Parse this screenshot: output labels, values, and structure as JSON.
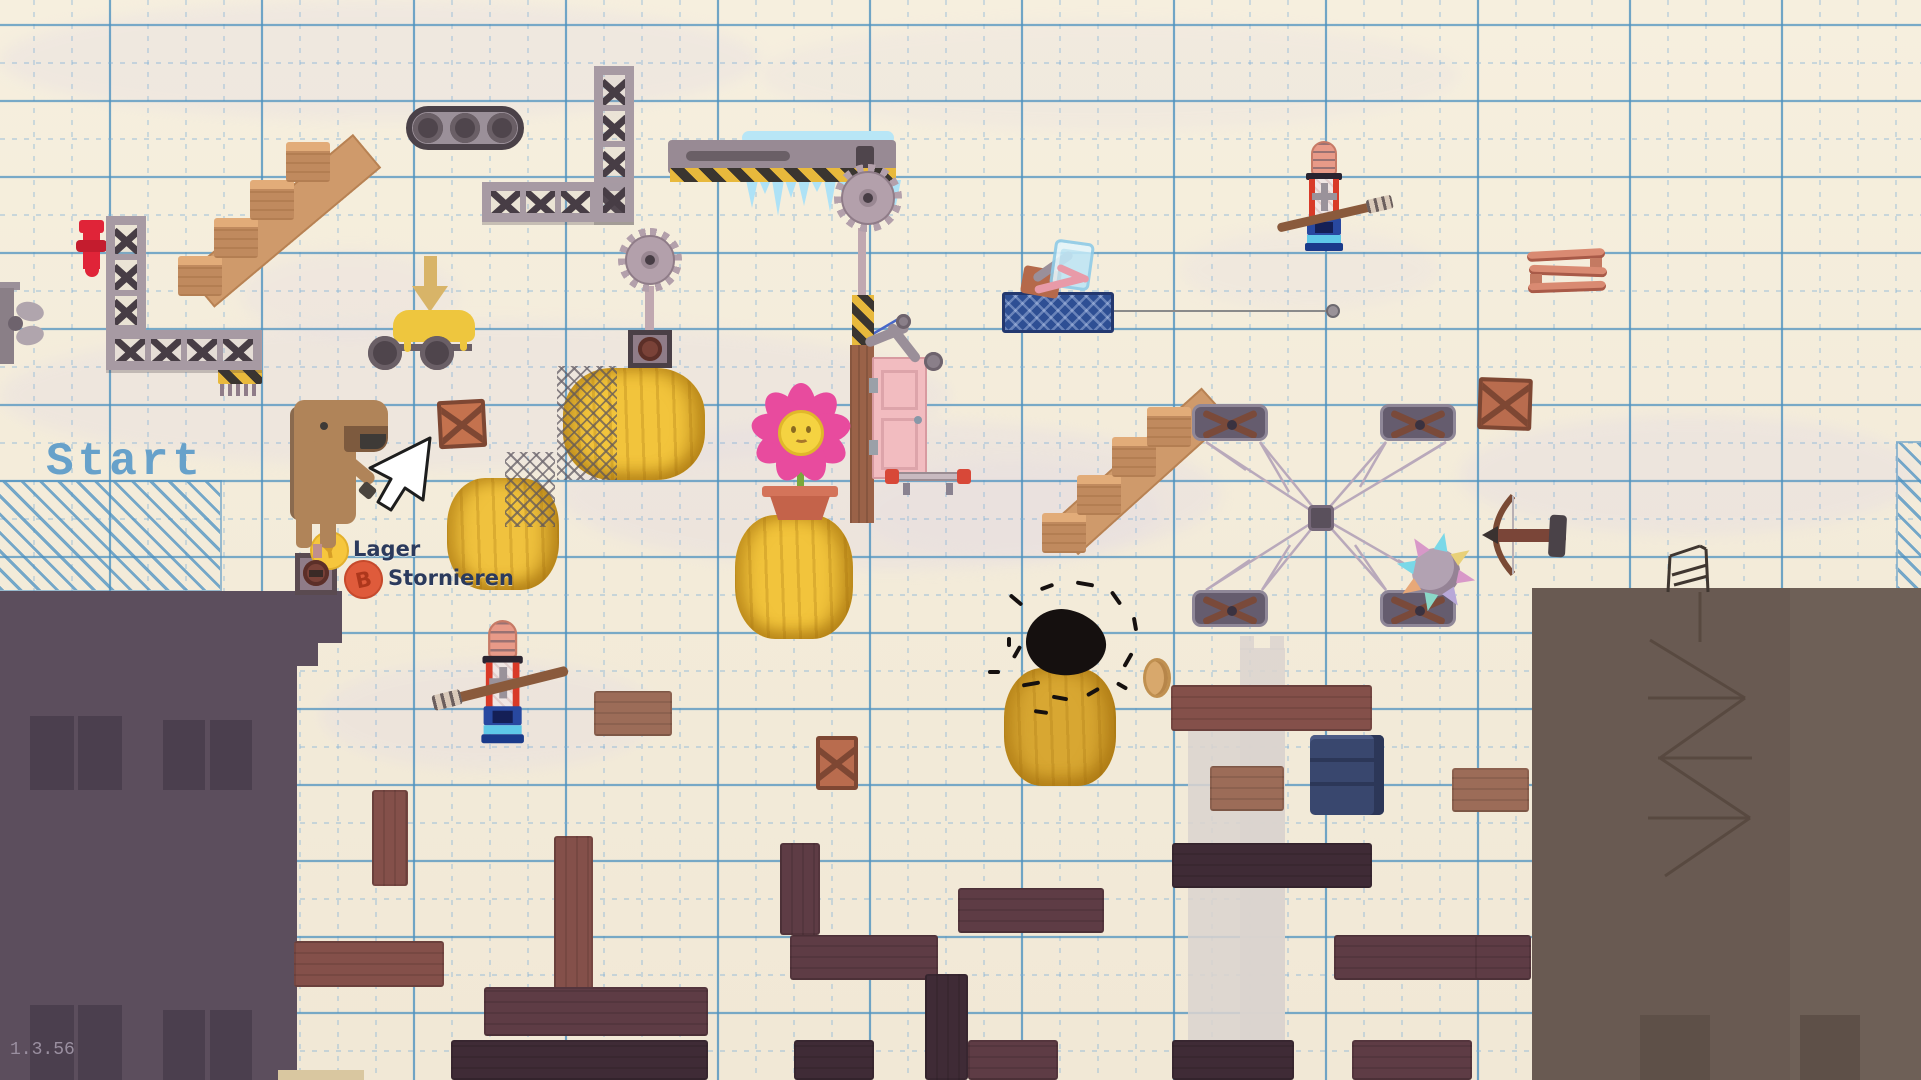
{
  "hud": {
    "start_zone_label": "Start",
    "store_button": {
      "key": "Y",
      "label": "Lager"
    },
    "cancel_button": {
      "key": "B",
      "label": "Stornieren"
    },
    "version": "1.3.56"
  },
  "colors": {
    "paper": "#f4ecd9",
    "grid_minor": "#7eb0d8",
    "grid_major": "#4f93c0",
    "hatch_blue": "#4a90c2",
    "start_text": "#67a1ca",
    "building_left": "#5c4e5d",
    "building_left_window": "#4b3f4e",
    "building_right": "#695a52",
    "hay_yellow": "#f2c43c",
    "hay_gold": "#d8a732",
    "button_y": "#f6c63d",
    "button_b": "#df5b3b",
    "label_navy": "#2b3a5c",
    "plank_medium": "#9c6c58",
    "plank_redbrown": "#84504a",
    "plank_dark": "#5e3c45",
    "plank_darkest": "#3f2b36",
    "scaffold_frame": "#a79aa3",
    "scaffold_brace": "#473d45",
    "saw_metal": "#b3a0ab",
    "ice_blue": "#aee2f6",
    "hazard_yellow": "#e8b93c",
    "door_pink": "#f2bcc0",
    "flower_pink": "#e84b9e",
    "flower_center": "#f5d341",
    "hydrant_red": "#e02438",
    "fence_blue": "#2e4f94",
    "barrel_navy": "#39476e"
  },
  "level": {
    "hay_bales": [
      {
        "x": 563,
        "y": 368,
        "w": 142,
        "h": 112,
        "c": "#f2c43c"
      },
      {
        "x": 447,
        "y": 478,
        "w": 112,
        "h": 112,
        "c": "#f0c23e"
      },
      {
        "x": 735,
        "y": 515,
        "w": 118,
        "h": 124,
        "c": "#f2c43c"
      },
      {
        "x": 1004,
        "y": 668,
        "w": 112,
        "h": 118,
        "c": "#d8a732"
      }
    ],
    "crates": [
      {
        "x": 438,
        "y": 400,
        "w": 48,
        "h": 48,
        "r": -3,
        "c": "#c4724e"
      },
      {
        "x": 1478,
        "y": 378,
        "w": 54,
        "h": 52,
        "r": 2,
        "c": "#b96c4e"
      },
      {
        "x": 816,
        "y": 736,
        "w": 42,
        "h": 54,
        "r": 0,
        "c": "#b96c4e"
      }
    ],
    "platforms": [
      {
        "x": 594,
        "y": 691,
        "w": 78,
        "h": 45,
        "s": "m"
      },
      {
        "x": 372,
        "y": 790,
        "w": 36,
        "h": 96,
        "s": "rb"
      },
      {
        "x": 294,
        "y": 941,
        "w": 150,
        "h": 46,
        "s": "rb"
      },
      {
        "x": 554,
        "y": 836,
        "w": 39,
        "h": 155,
        "s": "rb"
      },
      {
        "x": 484,
        "y": 987,
        "w": 224,
        "h": 49,
        "s": "d"
      },
      {
        "x": 451,
        "y": 1040,
        "w": 257,
        "h": 40,
        "s": "xd"
      },
      {
        "x": 790,
        "y": 935,
        "w": 148,
        "h": 45,
        "s": "d"
      },
      {
        "x": 780,
        "y": 843,
        "w": 40,
        "h": 92,
        "s": "d"
      },
      {
        "x": 925,
        "y": 974,
        "w": 43,
        "h": 106,
        "s": "xd"
      },
      {
        "x": 958,
        "y": 888,
        "w": 146,
        "h": 45,
        "s": "d"
      },
      {
        "x": 794,
        "y": 1040,
        "w": 80,
        "h": 40,
        "s": "xd"
      },
      {
        "x": 968,
        "y": 1040,
        "w": 90,
        "h": 40,
        "s": "d"
      },
      {
        "x": 1171,
        "y": 685,
        "w": 201,
        "h": 46,
        "s": "rb"
      },
      {
        "x": 1210,
        "y": 766,
        "w": 74,
        "h": 45,
        "s": "m"
      },
      {
        "x": 1452,
        "y": 768,
        "w": 77,
        "h": 44,
        "s": "m"
      },
      {
        "x": 1172,
        "y": 843,
        "w": 200,
        "h": 45,
        "s": "xd"
      },
      {
        "x": 1334,
        "y": 935,
        "w": 148,
        "h": 45,
        "s": "d"
      },
      {
        "x": 1475,
        "y": 935,
        "w": 56,
        "h": 45,
        "s": "d"
      },
      {
        "x": 1172,
        "y": 1040,
        "w": 122,
        "h": 40,
        "s": "xd"
      },
      {
        "x": 1352,
        "y": 1040,
        "w": 120,
        "h": 40,
        "s": "d"
      }
    ]
  }
}
